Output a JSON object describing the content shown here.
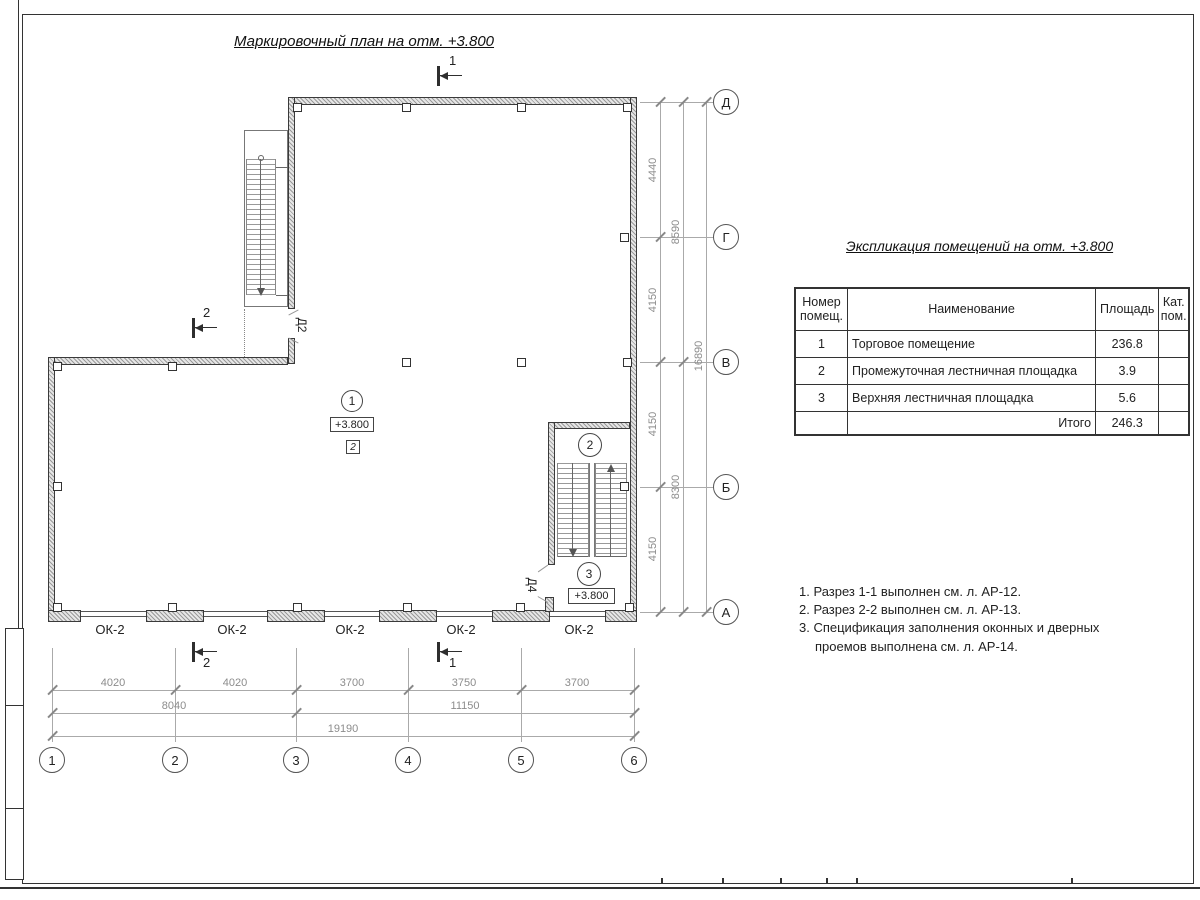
{
  "drawing": {
    "plan_title": "Маркировочный план на отм. +3.800",
    "schedule_title": "Экспликация помещений на отм. +3.800"
  },
  "schedule": {
    "headers": {
      "num": "Номер помещ.",
      "name": "Наименование",
      "area": "Площадь",
      "cat": "Кат. пом."
    },
    "rows": [
      {
        "num": "1",
        "name": "Торговое помещение",
        "area": "236.8",
        "cat": ""
      },
      {
        "num": "2",
        "name": "Промежуточная лестничная площадка",
        "area": "3.9",
        "cat": ""
      },
      {
        "num": "3",
        "name": "Верхняя лестничная площадка",
        "area": "5.6",
        "cat": ""
      }
    ],
    "total_label": "Итого",
    "total_area": "246.3"
  },
  "notes": {
    "line1": "1. Разрез 1-1 выполнен см. л. АР-12.",
    "line2": "2. Разрез 2-2 выполнен см. л. АР-13.",
    "line3": "3. Спецификация заполнения оконных и дверных",
    "line3b": "проемов выполнена см. л. АР-14."
  },
  "axes": {
    "vertical": [
      "Д",
      "Г",
      "В",
      "Б",
      "А"
    ],
    "horizontal": [
      "1",
      "2",
      "3",
      "4",
      "5",
      "6"
    ]
  },
  "dims": {
    "right_inner": [
      "4440",
      "4150",
      "4150",
      "4150"
    ],
    "right_mid": [
      "8590",
      "8300"
    ],
    "right_total": "16890",
    "bottom_inner": [
      "4020",
      "4020",
      "3700",
      "3750",
      "3700"
    ],
    "bottom_mid": [
      "8040",
      "11150"
    ],
    "bottom_total": "19190"
  },
  "plan": {
    "room1_tag": "1",
    "room1_elev": "+3.800",
    "room1_finish": "2",
    "stair_tag2": "2",
    "stair_tag3": "3",
    "stair_elev": "+3.800",
    "door_d2": "Д2",
    "door_d4": "Д4",
    "window_label": "ОК-2",
    "section1": "1",
    "section2": "2"
  }
}
